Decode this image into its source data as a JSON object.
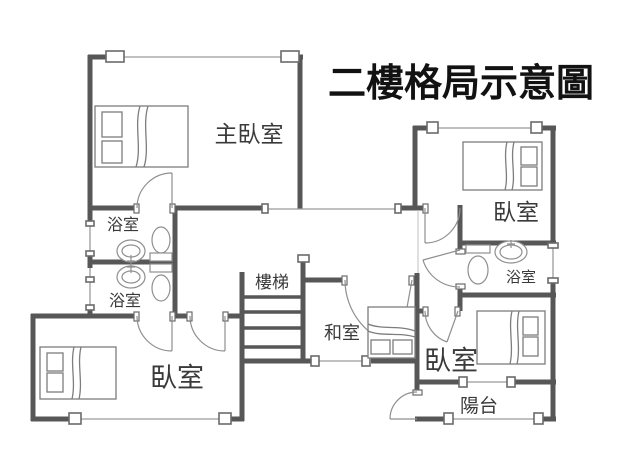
{
  "title": "二樓格局示意圖",
  "colors": {
    "background": "#ffffff",
    "wall": "#575757",
    "thin_line": "#9b9b9b",
    "fixture_line": "#8f8f8f",
    "label_text": "#3a3a3a",
    "title_text": "#121212"
  },
  "rooms": {
    "master_bedroom": {
      "label": "主臥室"
    },
    "bathroom_upper": {
      "label": "浴室"
    },
    "bathroom_lower": {
      "label": "浴室"
    },
    "stairs": {
      "label": "樓梯"
    },
    "tatami_room": {
      "label": "和室"
    },
    "bedroom_top_right": {
      "label": "臥室"
    },
    "bathroom_right": {
      "label": "浴室"
    },
    "bedroom_bottom_left": {
      "label": "臥室"
    },
    "bedroom_bottom_right": {
      "label": "臥室"
    },
    "balcony": {
      "label": "陽台"
    }
  }
}
